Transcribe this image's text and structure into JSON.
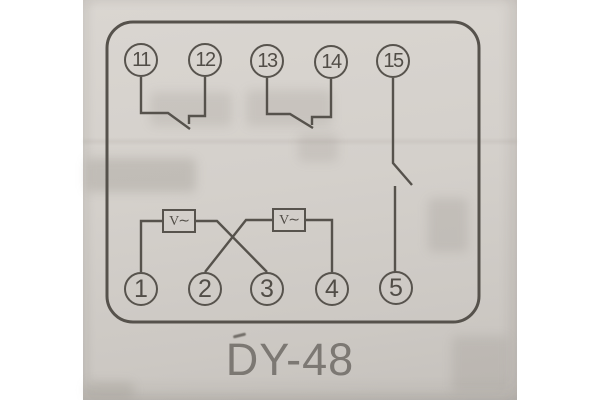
{
  "caption": "DY-48",
  "diagram": {
    "type": "relay-terminal-wiring-schematic",
    "top_terminals": [
      {
        "label": "11"
      },
      {
        "label": "12"
      },
      {
        "label": "13"
      },
      {
        "label": "14"
      },
      {
        "label": "15"
      }
    ],
    "bottom_terminals": [
      {
        "label": "1"
      },
      {
        "label": "2"
      },
      {
        "label": "3"
      },
      {
        "label": "4"
      },
      {
        "label": "5"
      }
    ],
    "voltage_elements": [
      {
        "label": "V∼"
      },
      {
        "label": "V∼"
      }
    ]
  },
  "colors": {
    "page_background": "#ffffff",
    "photo_background": "#d4d0cb",
    "ink": "#56524c",
    "terminal_text": "#514d47",
    "caption_text": "#7c7873"
  }
}
